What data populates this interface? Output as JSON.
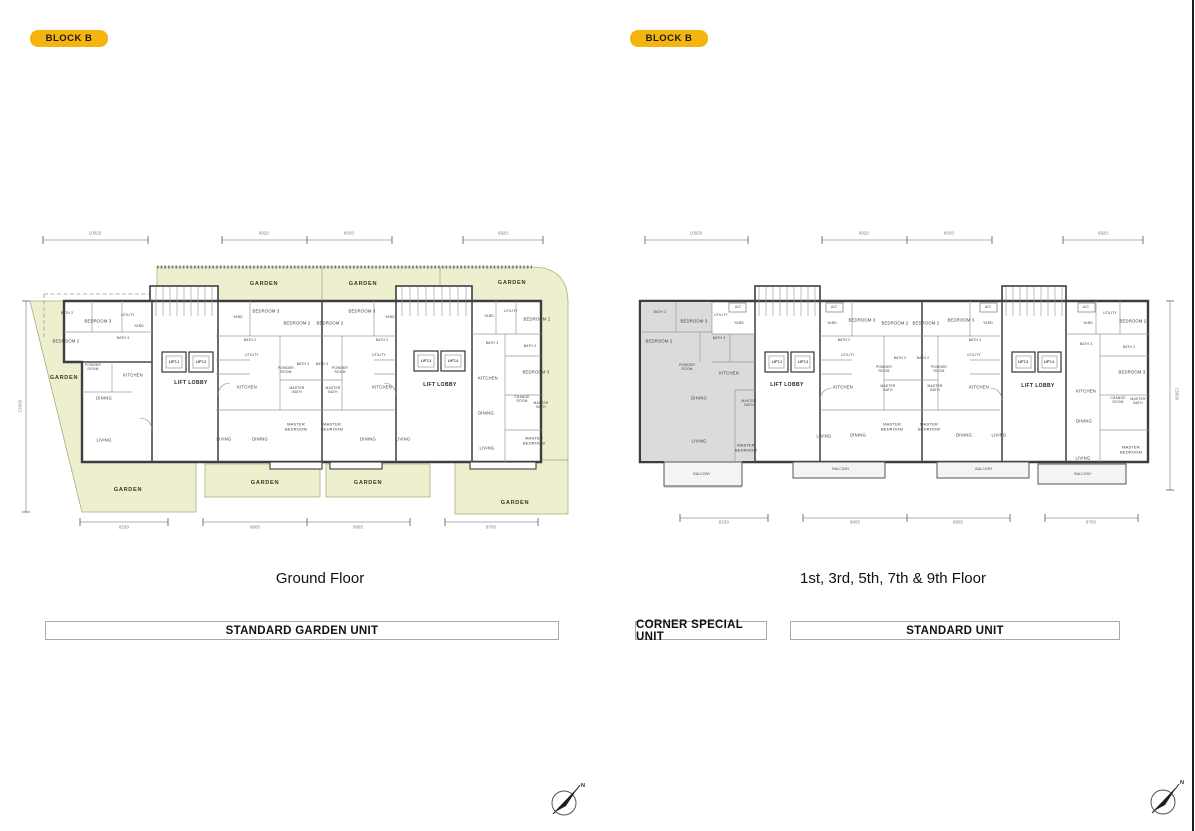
{
  "badges": {
    "left": "BLOCK B",
    "right": "BLOCK B"
  },
  "captions": {
    "left": "Ground Floor",
    "right": "1st, 3rd, 5th, 7th & 9th Floor"
  },
  "legend": {
    "standard_garden_unit": "STANDARD GARDEN UNIT",
    "corner_special_unit": "CORNER SPECIAL UNIT",
    "standard_unit": "STANDARD UNIT"
  },
  "compass": {
    "north_label": "N"
  },
  "colors": {
    "badge": "#F6B40E",
    "garden": "#EDEFCE",
    "corner_unit_shade": "#DBDBDB",
    "wall": "#3E3E3E"
  },
  "plans": {
    "ground": {
      "title": "Ground Floor",
      "dimensions": {
        "top": [
          "10020",
          "8020",
          "8020",
          "6920"
        ],
        "bottom": [
          "8230",
          "9805",
          "9805",
          "8700"
        ],
        "side": "15000"
      },
      "items": [
        {
          "t": "10020",
          "x": 95,
          "y": 234,
          "c": "dim"
        },
        {
          "t": "8020",
          "x": 264,
          "y": 234,
          "c": "dim"
        },
        {
          "t": "8020",
          "x": 349,
          "y": 234,
          "c": "dim"
        },
        {
          "t": "6920",
          "x": 503,
          "y": 234,
          "c": "dim"
        },
        {
          "t": "8230",
          "x": 124,
          "y": 528,
          "c": "dim"
        },
        {
          "t": "9805",
          "x": 255,
          "y": 528,
          "c": "dim"
        },
        {
          "t": "9805",
          "x": 358,
          "y": 528,
          "c": "dim"
        },
        {
          "t": "8700",
          "x": 491,
          "y": 528,
          "c": "dim"
        },
        {
          "t": "15000",
          "x": 21,
          "y": 406,
          "c": "dim rv"
        },
        {
          "t": "GARDEN",
          "x": 264,
          "y": 284,
          "c": "garden"
        },
        {
          "t": "GARDEN",
          "x": 363,
          "y": 284,
          "c": "garden"
        },
        {
          "t": "GARDEN",
          "x": 512,
          "y": 283,
          "c": "garden"
        },
        {
          "t": "GARDEN",
          "x": 64,
          "y": 378,
          "c": "garden"
        },
        {
          "t": "GARDEN",
          "x": 128,
          "y": 490,
          "c": "garden"
        },
        {
          "t": "GARDEN",
          "x": 265,
          "y": 483,
          "c": "garden"
        },
        {
          "t": "GARDEN",
          "x": 368,
          "y": 483,
          "c": "garden"
        },
        {
          "t": "GARDEN",
          "x": 515,
          "y": 503,
          "c": "garden"
        },
        {
          "t": "BATH 2",
          "x": 67,
          "y": 314,
          "c": "sm"
        },
        {
          "t": "BEDROOM 3",
          "x": 98,
          "y": 322
        },
        {
          "t": "UTILITY",
          "x": 128,
          "y": 316,
          "c": "sm"
        },
        {
          "t": "YARD",
          "x": 139,
          "y": 327,
          "c": "sm"
        },
        {
          "t": "BEDROOM 2",
          "x": 66,
          "y": 342
        },
        {
          "t": "BATH 3",
          "x": 123,
          "y": 339,
          "c": "sm"
        },
        {
          "t": "POWDER ROOM",
          "x": 93,
          "y": 368,
          "c": "sm w20"
        },
        {
          "t": "KITCHEN",
          "x": 133,
          "y": 376
        },
        {
          "t": "DINING",
          "x": 104,
          "y": 399
        },
        {
          "t": "LIVING",
          "x": 104,
          "y": 441
        },
        {
          "t": "LIFT-1",
          "x": 174,
          "y": 362,
          "c": "lift"
        },
        {
          "t": "LIFT-2",
          "x": 201,
          "y": 362,
          "c": "lift"
        },
        {
          "t": "LIFT LOBBY",
          "x": 191,
          "y": 384,
          "c": "lobby"
        },
        {
          "t": "YARD",
          "x": 238,
          "y": 318,
          "c": "sm"
        },
        {
          "t": "BEDROOM 3",
          "x": 266,
          "y": 312
        },
        {
          "t": "BEDROOM 2",
          "x": 297,
          "y": 324
        },
        {
          "t": "BATH 2",
          "x": 250,
          "y": 341,
          "c": "sm"
        },
        {
          "t": "UTILITY",
          "x": 252,
          "y": 356,
          "c": "sm"
        },
        {
          "t": "BATH 3",
          "x": 303,
          "y": 365,
          "c": "sm"
        },
        {
          "t": "POWDER ROOM",
          "x": 286,
          "y": 371,
          "c": "sm w20"
        },
        {
          "t": "MASTER BATH",
          "x": 297,
          "y": 391,
          "c": "sm w20"
        },
        {
          "t": "KITCHEN",
          "x": 247,
          "y": 388
        },
        {
          "t": "MASTER BEDROOM",
          "x": 296,
          "y": 427,
          "c": "w24"
        },
        {
          "t": "LIVING",
          "x": 224,
          "y": 440
        },
        {
          "t": "DINING",
          "x": 260,
          "y": 440
        },
        {
          "t": "BEDROOM 2",
          "x": 330,
          "y": 324
        },
        {
          "t": "BEDROOM 3",
          "x": 362,
          "y": 312
        },
        {
          "t": "YARD",
          "x": 390,
          "y": 318,
          "c": "sm"
        },
        {
          "t": "BATH 3",
          "x": 322,
          "y": 365,
          "c": "sm"
        },
        {
          "t": "POWDER ROOM",
          "x": 340,
          "y": 371,
          "c": "sm w20"
        },
        {
          "t": "BATH 2",
          "x": 382,
          "y": 341,
          "c": "sm"
        },
        {
          "t": "UTILITY",
          "x": 379,
          "y": 356,
          "c": "sm"
        },
        {
          "t": "MASTER BATH",
          "x": 333,
          "y": 391,
          "c": "sm w20"
        },
        {
          "t": "KITCHEN",
          "x": 382,
          "y": 388
        },
        {
          "t": "MASTER BEDROOM",
          "x": 332,
          "y": 427,
          "c": "w24"
        },
        {
          "t": "DINING",
          "x": 368,
          "y": 440
        },
        {
          "t": "LIVING",
          "x": 403,
          "y": 440
        },
        {
          "t": "LIFT-3",
          "x": 426,
          "y": 361,
          "c": "lift"
        },
        {
          "t": "LIFT-4",
          "x": 453,
          "y": 361,
          "c": "lift"
        },
        {
          "t": "LIFT LOBBY",
          "x": 440,
          "y": 386,
          "c": "lobby"
        },
        {
          "t": "YARD",
          "x": 489,
          "y": 317,
          "c": "sm"
        },
        {
          "t": "UTILITY",
          "x": 511,
          "y": 312,
          "c": "sm"
        },
        {
          "t": "BEDROOM 2",
          "x": 537,
          "y": 320
        },
        {
          "t": "BATH 3",
          "x": 492,
          "y": 344,
          "c": "sm"
        },
        {
          "t": "BATH 2",
          "x": 530,
          "y": 347,
          "c": "sm"
        },
        {
          "t": "BEDROOM 3",
          "x": 536,
          "y": 373
        },
        {
          "t": "KITCHEN",
          "x": 488,
          "y": 379
        },
        {
          "t": "CHANGE ROOM",
          "x": 522,
          "y": 400,
          "c": "sm w20"
        },
        {
          "t": "MASTER BATH",
          "x": 541,
          "y": 406,
          "c": "sm w20"
        },
        {
          "t": "DINING",
          "x": 486,
          "y": 414
        },
        {
          "t": "MASTER BEDROOM",
          "x": 534,
          "y": 441,
          "c": "w24"
        },
        {
          "t": "LIVING",
          "x": 487,
          "y": 449
        }
      ]
    },
    "upper": {
      "title": "1st, 3rd, 5th, 7th & 9th Floor",
      "dimensions": {
        "top": [
          "10020",
          "8020",
          "8020",
          "6920"
        ],
        "bottom": [
          "8230",
          "9805",
          "9805",
          "8700"
        ],
        "side": "15000"
      },
      "items": [
        {
          "t": "10020",
          "x": 696,
          "y": 234,
          "c": "dim"
        },
        {
          "t": "8020",
          "x": 864,
          "y": 234,
          "c": "dim"
        },
        {
          "t": "8020",
          "x": 949,
          "y": 234,
          "c": "dim"
        },
        {
          "t": "6920",
          "x": 1103,
          "y": 234,
          "c": "dim"
        },
        {
          "t": "8230",
          "x": 724,
          "y": 523,
          "c": "dim"
        },
        {
          "t": "9805",
          "x": 855,
          "y": 523,
          "c": "dim"
        },
        {
          "t": "9805",
          "x": 958,
          "y": 523,
          "c": "dim"
        },
        {
          "t": "8700",
          "x": 1091,
          "y": 523,
          "c": "dim"
        },
        {
          "t": "15000",
          "x": 1176,
          "y": 394,
          "c": "dim rv2"
        },
        {
          "t": "BATH 2",
          "x": 660,
          "y": 313,
          "c": "sm"
        },
        {
          "t": "BEDROOM 3",
          "x": 694,
          "y": 322
        },
        {
          "t": "UTILITY",
          "x": 721,
          "y": 316,
          "c": "sm"
        },
        {
          "t": "A/C",
          "x": 738,
          "y": 308,
          "c": "sm"
        },
        {
          "t": "YARD",
          "x": 739,
          "y": 324,
          "c": "sm"
        },
        {
          "t": "BEDROOM 2",
          "x": 659,
          "y": 342
        },
        {
          "t": "BATH 3",
          "x": 719,
          "y": 339,
          "c": "sm"
        },
        {
          "t": "POWDER ROOM",
          "x": 687,
          "y": 368,
          "c": "sm w20"
        },
        {
          "t": "KITCHEN",
          "x": 729,
          "y": 374
        },
        {
          "t": "DINING",
          "x": 699,
          "y": 399
        },
        {
          "t": "MASTER BATH",
          "x": 749,
          "y": 404,
          "c": "sm w20"
        },
        {
          "t": "LIVING",
          "x": 699,
          "y": 442
        },
        {
          "t": "MASTER BEDROOM",
          "x": 746,
          "y": 448,
          "c": "w24"
        },
        {
          "t": "BALCONY",
          "x": 702,
          "y": 475,
          "c": "sm"
        },
        {
          "t": "LIFT-1",
          "x": 777,
          "y": 362,
          "c": "lift"
        },
        {
          "t": "LIFT-2",
          "x": 803,
          "y": 362,
          "c": "lift"
        },
        {
          "t": "LIFT LOBBY",
          "x": 787,
          "y": 386,
          "c": "lobby"
        },
        {
          "t": "A/C",
          "x": 834,
          "y": 308,
          "c": "sm"
        },
        {
          "t": "YARD",
          "x": 832,
          "y": 324,
          "c": "sm"
        },
        {
          "t": "BEDROOM 3",
          "x": 862,
          "y": 321
        },
        {
          "t": "BEDROOM 2",
          "x": 895,
          "y": 324
        },
        {
          "t": "BATH 2",
          "x": 844,
          "y": 341,
          "c": "sm"
        },
        {
          "t": "UTILITY",
          "x": 848,
          "y": 356,
          "c": "sm"
        },
        {
          "t": "BATH 2",
          "x": 900,
          "y": 359,
          "c": "sm"
        },
        {
          "t": "POWDER ROOM",
          "x": 884,
          "y": 370,
          "c": "sm w20"
        },
        {
          "t": "MASTER BATH",
          "x": 888,
          "y": 389,
          "c": "sm w20"
        },
        {
          "t": "KITCHEN",
          "x": 843,
          "y": 388
        },
        {
          "t": "MASTER BEDROOM",
          "x": 892,
          "y": 427,
          "c": "w24"
        },
        {
          "t": "DINING",
          "x": 858,
          "y": 436
        },
        {
          "t": "LIVING",
          "x": 824,
          "y": 437
        },
        {
          "t": "BALCONY",
          "x": 841,
          "y": 470,
          "c": "sm"
        },
        {
          "t": "BEDROOM 2",
          "x": 926,
          "y": 324
        },
        {
          "t": "BEDROOM 3",
          "x": 961,
          "y": 321
        },
        {
          "t": "YARD",
          "x": 988,
          "y": 324,
          "c": "sm"
        },
        {
          "t": "A/C",
          "x": 988,
          "y": 308,
          "c": "sm"
        },
        {
          "t": "BATH 2",
          "x": 923,
          "y": 359,
          "c": "sm"
        },
        {
          "t": "POWDER ROOM",
          "x": 939,
          "y": 370,
          "c": "sm w20"
        },
        {
          "t": "BATH 2",
          "x": 975,
          "y": 341,
          "c": "sm"
        },
        {
          "t": "UTILITY",
          "x": 974,
          "y": 356,
          "c": "sm"
        },
        {
          "t": "MASTER BATH",
          "x": 935,
          "y": 389,
          "c": "sm w20"
        },
        {
          "t": "KITCHEN",
          "x": 979,
          "y": 388
        },
        {
          "t": "MASTER BEDROOM",
          "x": 929,
          "y": 427,
          "c": "w24"
        },
        {
          "t": "DINING",
          "x": 964,
          "y": 436
        },
        {
          "t": "LIVING",
          "x": 999,
          "y": 436
        },
        {
          "t": "BALCONY",
          "x": 984,
          "y": 470,
          "c": "sm"
        },
        {
          "t": "LIFT-3",
          "x": 1023,
          "y": 362,
          "c": "lift"
        },
        {
          "t": "LIFT-4",
          "x": 1049,
          "y": 362,
          "c": "lift"
        },
        {
          "t": "LIFT LOBBY",
          "x": 1038,
          "y": 387,
          "c": "lobby"
        },
        {
          "t": "A/C",
          "x": 1086,
          "y": 308,
          "c": "sm"
        },
        {
          "t": "UTILITY",
          "x": 1110,
          "y": 314,
          "c": "sm"
        },
        {
          "t": "YARD",
          "x": 1088,
          "y": 324,
          "c": "sm"
        },
        {
          "t": "BEDROOM 2",
          "x": 1133,
          "y": 322
        },
        {
          "t": "BATH 3",
          "x": 1086,
          "y": 345,
          "c": "sm"
        },
        {
          "t": "BATH 2",
          "x": 1129,
          "y": 348,
          "c": "sm"
        },
        {
          "t": "BEDROOM 3",
          "x": 1132,
          "y": 373
        },
        {
          "t": "KITCHEN",
          "x": 1086,
          "y": 392
        },
        {
          "t": "CHANGE ROOM",
          "x": 1118,
          "y": 401,
          "c": "sm w20"
        },
        {
          "t": "MASTER BATH",
          "x": 1138,
          "y": 402,
          "c": "sm w20"
        },
        {
          "t": "DINING",
          "x": 1084,
          "y": 422
        },
        {
          "t": "MASTER BEDROOM",
          "x": 1131,
          "y": 450,
          "c": "w24"
        },
        {
          "t": "LIVING",
          "x": 1083,
          "y": 459
        },
        {
          "t": "BALCONY",
          "x": 1083,
          "y": 475,
          "c": "sm"
        }
      ]
    }
  }
}
